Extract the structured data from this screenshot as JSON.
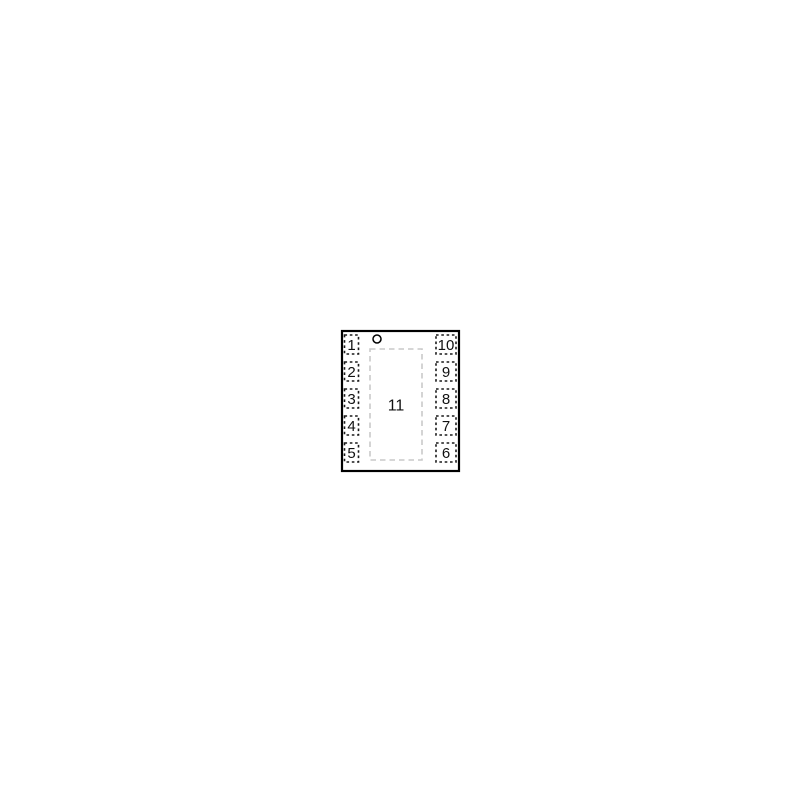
{
  "diagram": {
    "left_pins": [
      "1",
      "2",
      "3",
      "4",
      "5"
    ],
    "right_pins": [
      "10",
      "9",
      "8",
      "7",
      "6"
    ],
    "center_pad_label": "11",
    "colors": {
      "package_outline": "#000000",
      "pin_pad_dash": "#1a1a1a",
      "exposed_pad_dash": "#c9c9c9",
      "background": "#ffffff",
      "text": "#111111"
    }
  }
}
